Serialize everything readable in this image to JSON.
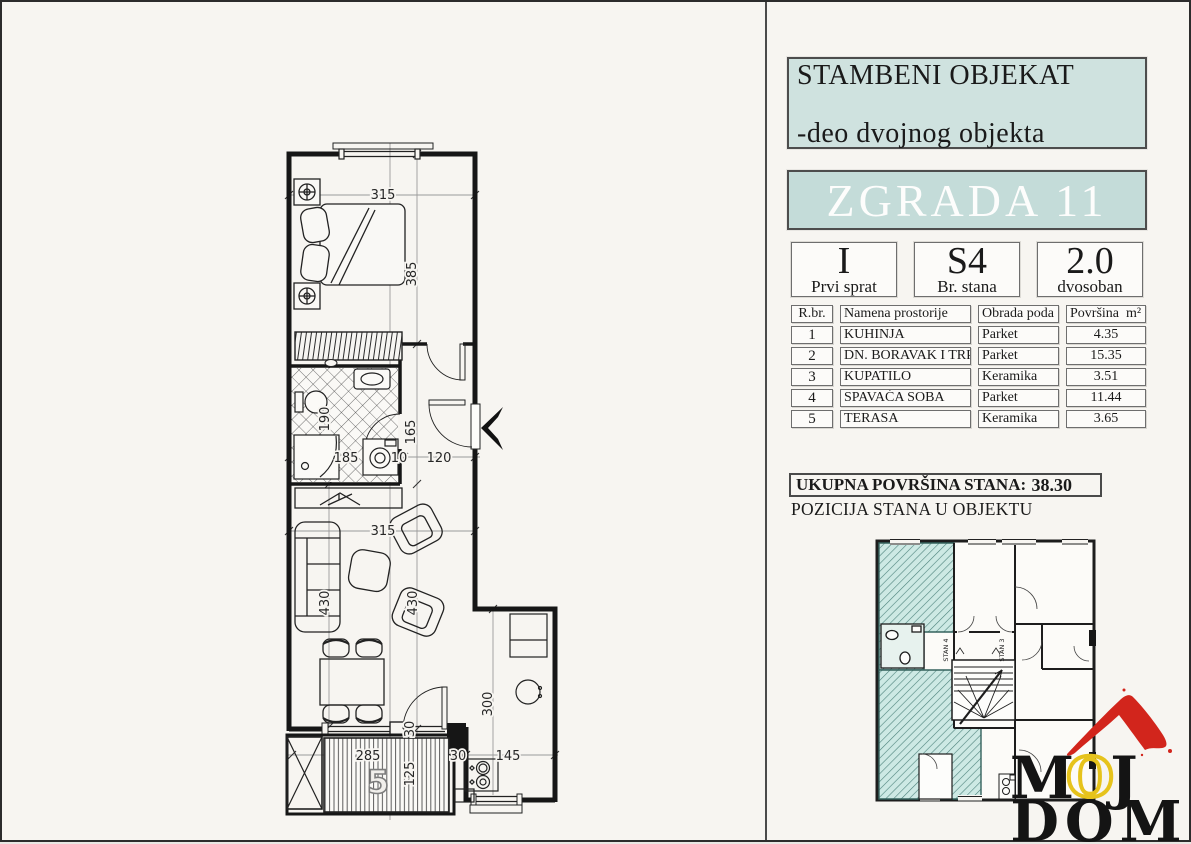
{
  "panel": {
    "header_lines": [
      "STAMBENI OBJEKAT",
      "-deo dvojnog objekta",
      "SPRATNOSTI P+1+Pk"
    ],
    "building": "ZGRADA 11",
    "info_boxes": [
      {
        "value": "I",
        "label": "Prvi sprat"
      },
      {
        "value": "S4",
        "label": "Br. stana"
      },
      {
        "value": "2.0",
        "label": "dvosoban"
      }
    ],
    "table": {
      "headers": [
        "R.br.",
        "Namena prostorije",
        "Obrada poda",
        "Površina  m²"
      ],
      "rows": [
        [
          "1",
          "KUHINJA",
          "Parket",
          "4.35"
        ],
        [
          "2",
          "DN. BORAVAK I TRP.",
          "Parket",
          "15.35"
        ],
        [
          "3",
          "KUPATILO",
          "Keramika",
          "3.51"
        ],
        [
          "4",
          "SPAVAĆA SOBA",
          "Parket",
          "11.44"
        ],
        [
          "5",
          "TERASA",
          "Keramika",
          "3.65"
        ]
      ]
    },
    "total_label": "UKUPNA POVRŠINA STANA:",
    "total_value": "38.30",
    "position_label": "POZICIJA STANA U OBJEKTU",
    "mini_plan": {
      "stan4": "STAN 4",
      "stan3": "STAN 3"
    }
  },
  "plan": {
    "dims": {
      "bedroom_width": "315",
      "bedroom_depth": "385",
      "bathroom_depth": "190",
      "bathroom_width": "185",
      "wall_thickness": "10",
      "hallway_width": "120",
      "hallway_depth": "165",
      "living_width": "315",
      "living_depth_left": "430",
      "living_depth_right": "430",
      "kitchen_depth": "300",
      "balcony_door": "30",
      "terrace_width": "285",
      "terrace_depth": "125",
      "terrace_edge": "30",
      "kitchen_width": "145"
    },
    "terrace_number": "5"
  },
  "logo": {
    "m": "M",
    "o": "O",
    "j": "J",
    "dom": "DOM"
  },
  "colors": {
    "teal_box": "#cfe2df",
    "teal_band": "#c4dcd9",
    "mini_hatch_bg": "#cde9e4",
    "mini_hatch_line": "#4e837c",
    "logo_red": "#d2251c",
    "logo_yellow": "#e6c31c"
  }
}
